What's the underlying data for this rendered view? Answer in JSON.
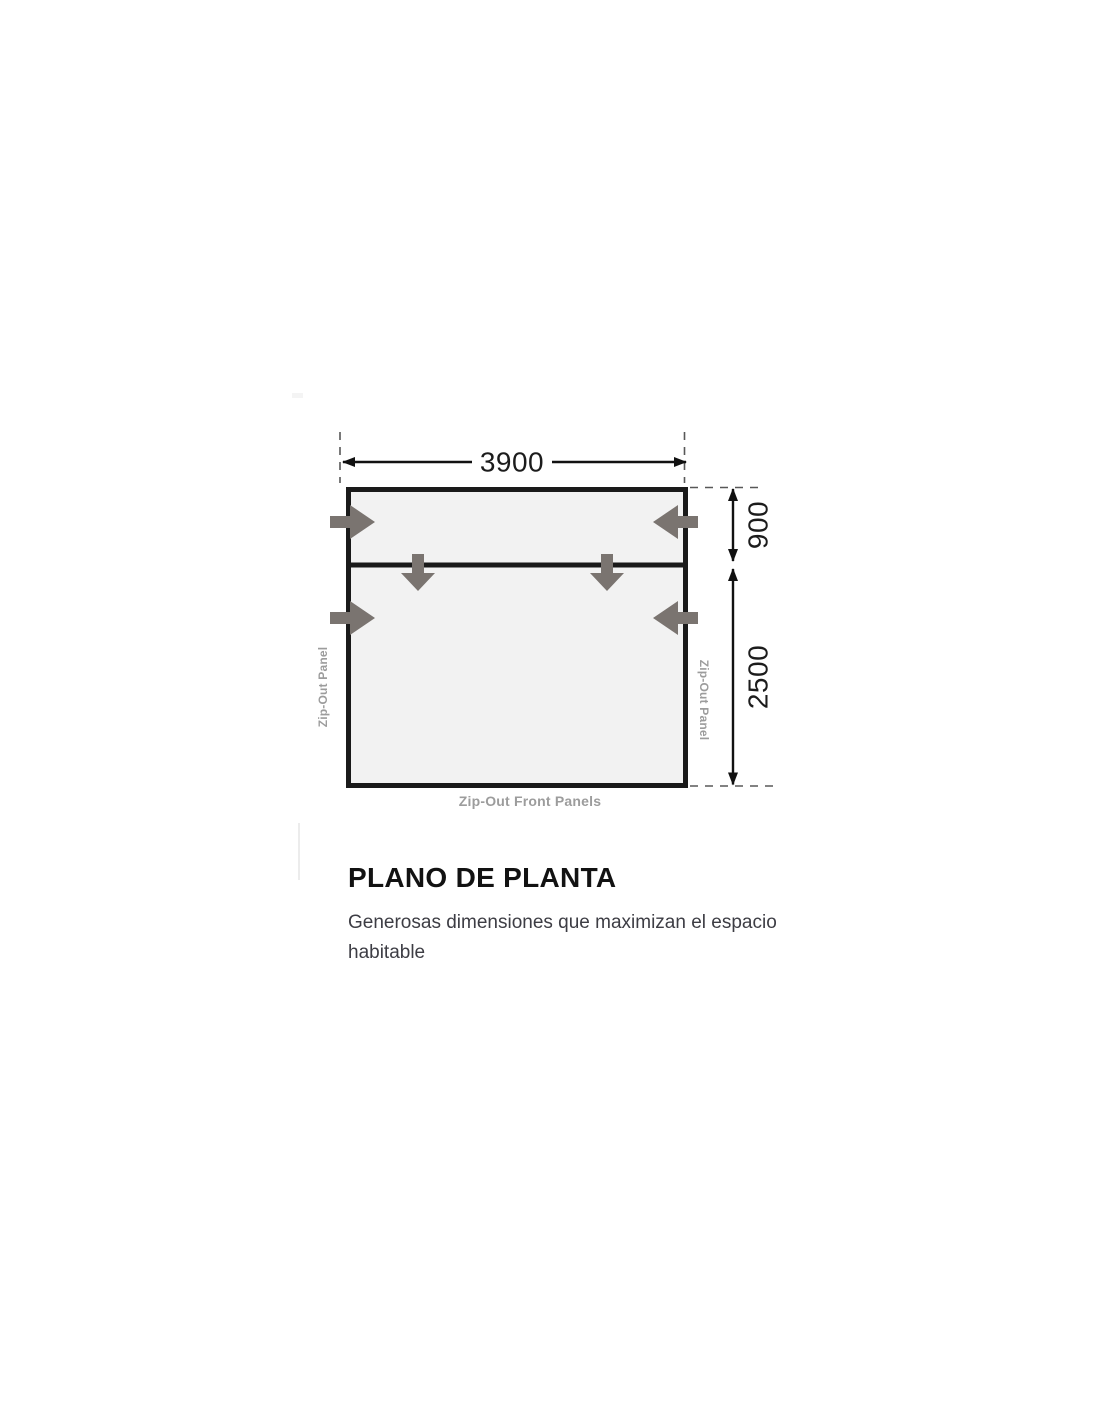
{
  "floor_plan": {
    "dimensions": {
      "width": "3900",
      "top_section_depth": "900",
      "main_section_depth": "2500"
    },
    "labels": {
      "left_panel": "Zip-Out Panel",
      "right_panel": "Zip-Out Panel",
      "front_panels": "Zip-Out Front Panels"
    },
    "colors": {
      "outline": "#1a1a1a",
      "interior_fill": "#f2f2f2",
      "arrow": "#7a7470",
      "dimension_text": "#1c1c1c",
      "panel_label_text": "#9c9c9c",
      "dashed_guide": "#585858"
    }
  },
  "section": {
    "title": "PLANO DE PLANTA",
    "subtitle": "Generosas dimensiones que maximizan el espacio habitable"
  }
}
